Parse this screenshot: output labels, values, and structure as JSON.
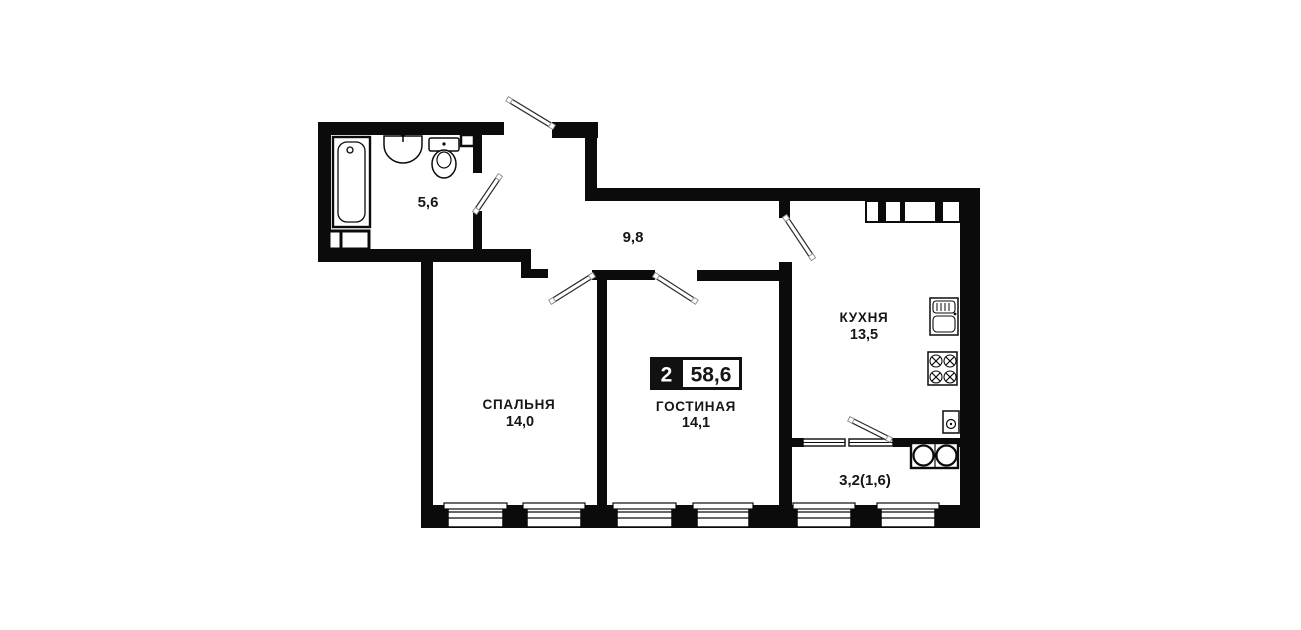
{
  "floorplan": {
    "badge": {
      "room_count": "2",
      "total_area": "58,6"
    },
    "rooms": {
      "bathroom": {
        "name": "",
        "area": "5,6"
      },
      "hallway": {
        "name": "",
        "area": "9,8"
      },
      "kitchen": {
        "name": "КУХНЯ",
        "area": "13,5"
      },
      "bedroom": {
        "name": "СПАЛЬНЯ",
        "area": "14,0"
      },
      "living": {
        "name": "ГОСТИНАЯ",
        "area": "14,1"
      },
      "balcony": {
        "name": "",
        "area": "3,2(1,6)"
      }
    },
    "fixtures": [
      "bathtub",
      "wash-basin",
      "toilet",
      "vent-shaft",
      "kitchen-sink",
      "stove",
      "water-heater",
      "washer-columns"
    ],
    "colors": {
      "wall": "#0b0b0b",
      "background": "#ffffff",
      "badge_fill": "#111111"
    }
  }
}
